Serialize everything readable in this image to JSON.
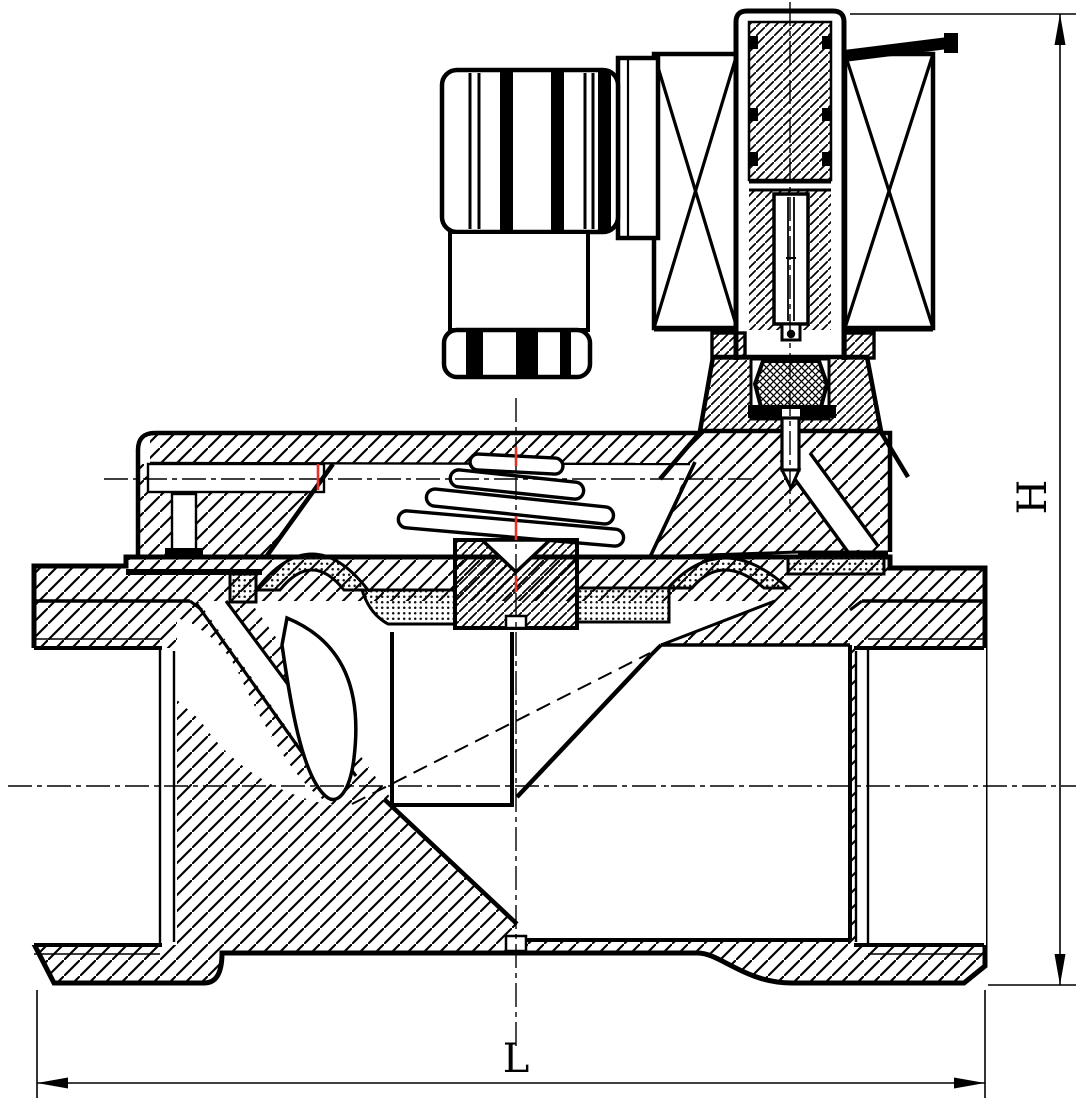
{
  "drawing": {
    "title": "solenoid-valve-cross-section",
    "dimensions": {
      "length_label": "L",
      "height_label": "H"
    },
    "colors": {
      "line": "#000000",
      "background": "#ffffff",
      "centerline_accent": "#e63226"
    },
    "parts": [
      "din-connector",
      "solenoid-coil",
      "coil-winding-left",
      "coil-winding-right",
      "armature-tube",
      "fixed-core",
      "plunger",
      "mounting-bracket",
      "gland-nut",
      "pilot-seal",
      "pilot-stem",
      "valve-bonnet",
      "return-spring",
      "diaphragm",
      "diaphragm-insert",
      "valve-body",
      "inlet-port",
      "outlet-port",
      "pilot-channel"
    ]
  }
}
